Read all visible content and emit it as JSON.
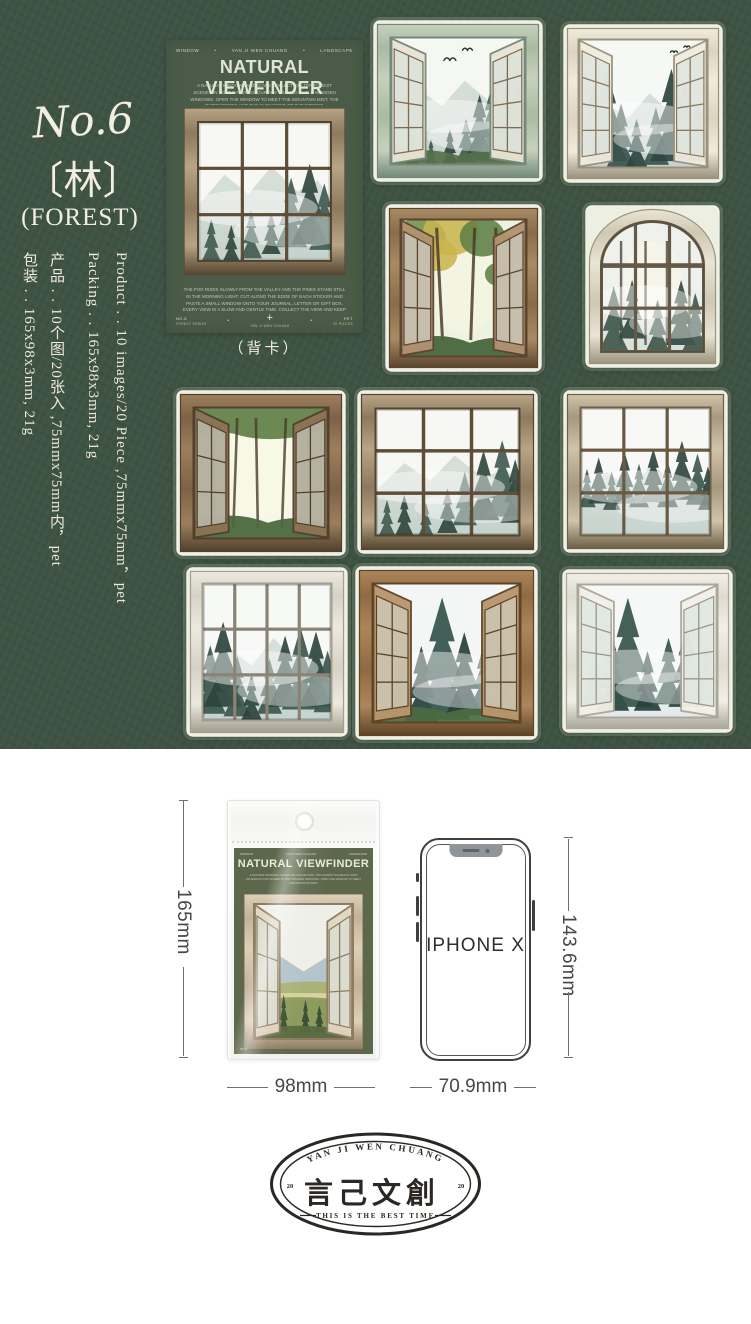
{
  "colors": {
    "background_green": "#3e5343",
    "back_card_green": "#4a5b48",
    "package_card_green": "#5d674b",
    "text_cream": "#f2efe0",
    "stamp_ink": "#2b2723",
    "dimension_line": "#6f6f6f",
    "white": "#ffffff"
  },
  "left_panel": {
    "number": "No.6",
    "kanji": "〔林〕",
    "name": "(FOREST)",
    "columns": [
      {
        "id": "packing-cn",
        "text": "包装 . . 165x98x3mm, 21g"
      },
      {
        "id": "product-cn",
        "text": "产品 . . 10个图/20张入 ,75mmx75mm内，pet"
      },
      {
        "id": "packing-en",
        "text": "Packing . . 165x98x3mm, 21g"
      },
      {
        "id": "product-en",
        "text": "Product . . 10 images/20 Piece ,75mmx75mm，pet"
      }
    ]
  },
  "back_card": {
    "header": {
      "left": "WINDOW",
      "center": "YAN JI WEN CHUANG",
      "right": "LANDSCAPE",
      "dot": "•"
    },
    "title": "NATURAL VIEWFINDER",
    "intro": "A NATURAL WINDOW LANDSCAPE COLLECTION. TEN FOREST SCENES IN SOFT WATERCOLOUR ARE FRAMED IN OLD WOODEN WINDOWS. OPEN THE WINDOW TO MEET THE MOUNTAIN MIST, THE QUIET WOODS AND THE SLOW WIND OF THE FOREST.",
    "desc": "THE FOG RISES SLOWLY FROM THE VALLEY AND THE PINES STAND STILL IN THE MORNING LIGHT. CUT ALONG THE EDGE OF EACH STICKER AND PASTE A SMALL WINDOW ONTO YOUR JOURNAL, LETTER OR GIFT BOX. EVERY VIEW IS A SLOW AND GENTLE TIME. COLLECT THE VIEW AND KEEP THE TIME. TEN IMAGES, TWENTY PIECES, PET MATERIAL.",
    "footer": {
      "left_top": "NO.6",
      "left_sub": "FOREST SERIES",
      "plus": "+",
      "center_sub": "YAN JI WEN CHUANG",
      "right_top": "PET",
      "right_sub": "20 PIECES",
      "dot": "•"
    },
    "caption": "（背卡）",
    "window": {
      "id": "cw",
      "kind": "grid",
      "cut": false,
      "fw": 14,
      "frame": {
        "light": "#b7a485",
        "mid": "#8d7a5e",
        "dark": "#55452f",
        "muntin": "#5e4e38"
      },
      "grid": {
        "cols": 3,
        "rows": 3
      },
      "scene": {
        "sky": "#f7f8f4",
        "fog": "#dee6e1",
        "tree": "#415c52",
        "tree2": "#31483f",
        "ridge": 0.5
      },
      "trees": [
        [
          0.1,
          1,
          0.3
        ],
        [
          0.25,
          1,
          0.26
        ],
        [
          0.4,
          0.98,
          0.34
        ],
        [
          0.55,
          0.95,
          0.3
        ],
        [
          0.7,
          0.9,
          0.5
        ],
        [
          0.84,
          0.88,
          0.58
        ],
        [
          0.95,
          0.92,
          0.48
        ]
      ]
    }
  },
  "stickers": [
    {
      "id": "w1",
      "name": "open casement window, misty mountains with birds",
      "kind": "open",
      "cut": true,
      "fw": 13,
      "sashRows": 4,
      "frame": {
        "light": "#c6d1bd",
        "mid": "#a9bba3",
        "dark": "#74897a",
        "muntin": "#7d6c54",
        "sash": "#e9e5d5"
      },
      "scene": {
        "sky": "#f5f7f3",
        "fog": "#dde6e0",
        "tree": "#3f5a50",
        "tree2": "#2f473f",
        "ridge": 0.52,
        "ground": true,
        "groundColor": "#55704a"
      },
      "trees": [
        [
          0.05,
          1,
          0.2
        ],
        [
          0.16,
          1,
          0.24
        ],
        [
          0.3,
          1,
          0.2
        ],
        [
          0.44,
          1,
          0.28
        ],
        [
          0.56,
          0.98,
          0.34
        ],
        [
          0.66,
          0.95,
          0.5
        ],
        [
          0.76,
          0.97,
          0.62
        ],
        [
          0.86,
          0.92,
          0.52
        ],
        [
          0.95,
          0.96,
          0.58
        ]
      ],
      "birds": true
    },
    {
      "id": "w2",
      "name": "open casement window, foggy pine forest",
      "kind": "open",
      "cut": true,
      "fw": 11,
      "sashRows": 4,
      "frame": {
        "light": "#f0ebdc",
        "mid": "#ddd4c0",
        "dark": "#9a917c",
        "muntin": "#8a7a5f",
        "sash": "#efece0"
      },
      "scene": {
        "sky": "#f6f8f6",
        "fog": "#dfe7e6",
        "tree": "#3a554e",
        "tree2": "#2c453f",
        "ridge": 0.6
      },
      "trees": [
        [
          0.12,
          0.9,
          0.55
        ],
        [
          0.22,
          0.95,
          0.7
        ],
        [
          0.33,
          1,
          0.5
        ],
        [
          0.45,
          1,
          0.38
        ],
        [
          0.6,
          0.98,
          0.45
        ],
        [
          0.72,
          0.95,
          0.72
        ],
        [
          0.83,
          0.9,
          0.58
        ],
        [
          0.93,
          0.95,
          0.48
        ]
      ],
      "birds": "small"
    },
    {
      "id": "w3",
      "name": "open wooden window, lush green forest with golden leaves",
      "kind": "open",
      "cut": true,
      "fw": 11,
      "sashRows": 3,
      "frame": {
        "light": "#a98a63",
        "mid": "#8a6c4a",
        "dark": "#5c452f",
        "muntin": "#5c452f",
        "sash": "#b29272"
      },
      "scene": {
        "sky": "#eef2e0",
        "lush": true,
        "tree": "#5f7f45"
      },
      "trees": []
    },
    {
      "id": "w4",
      "name": "arched stone window, deep forest glow",
      "kind": "arch",
      "cut": true,
      "fw": 12,
      "arch": 0.34,
      "frame": {
        "light": "#e9e4d4",
        "mid": "#cfc8b2",
        "dark": "#9b947e",
        "muntin": "#655948"
      },
      "grid": {
        "cols": 3,
        "rows": 3
      },
      "scene": {
        "sky": "#eef1ec",
        "fog": "#d6dfd9",
        "tree": "#41584c",
        "tree2": "#33493f",
        "bright": [
          0.5,
          0.45
        ],
        "trunks": [
          0.18,
          0.42,
          0.63,
          0.85
        ]
      },
      "trees": [
        [
          0.12,
          1,
          0.5
        ],
        [
          0.3,
          0.9,
          0.45
        ],
        [
          0.55,
          1,
          0.4
        ],
        [
          0.78,
          0.95,
          0.5
        ],
        [
          0.92,
          1,
          0.45
        ]
      ]
    },
    {
      "id": "w5",
      "name": "open brown window, sunlit summer forest",
      "kind": "open",
      "cut": true,
      "fw": 13,
      "sashRows": 3,
      "frame": {
        "light": "#9c7f5d",
        "mid": "#7c6248",
        "dark": "#52402c",
        "muntin": "#52402c",
        "sash": "#8d7356"
      },
      "scene": {
        "sky": "#f6f7e8",
        "sunny": true,
        "tree": "#5d7c43"
      },
      "trees": []
    },
    {
      "id": "w6",
      "name": "rustic nine-pane window, misty pines",
      "kind": "grid",
      "cut": true,
      "fw": 14,
      "frame": {
        "light": "#b7a485",
        "mid": "#8d7a5e",
        "dark": "#55452f",
        "muntin": "#5e4e38"
      },
      "grid": {
        "cols": 3,
        "rows": 3
      },
      "scene": {
        "sky": "#f7f8f4",
        "fog": "#dee6e1",
        "tree": "#415c52",
        "tree2": "#31483f",
        "ridge": 0.55
      },
      "trees": [
        [
          0.08,
          1,
          0.28
        ],
        [
          0.2,
          1,
          0.32
        ],
        [
          0.35,
          1,
          0.26
        ],
        [
          0.5,
          0.98,
          0.35
        ],
        [
          0.62,
          0.92,
          0.42
        ],
        [
          0.75,
          0.88,
          0.55
        ],
        [
          0.88,
          0.85,
          0.6
        ],
        [
          0.97,
          0.9,
          0.5
        ]
      ]
    },
    {
      "id": "w7",
      "name": "whitewashed nine-pane window, fog over pine ridge",
      "kind": "grid",
      "cut": true,
      "fw": 13,
      "frame": {
        "light": "#cfc3a9",
        "mid": "#a79880",
        "dark": "#6e6046",
        "muntin": "#6a5a42"
      },
      "grid": {
        "cols": 3,
        "rows": 3
      },
      "scene": {
        "sky": "#f8f9f6",
        "fog": "#e2e9e6",
        "tree": "#3e584f",
        "tree2": "#2f463e",
        "ridge": 0.62
      },
      "trees": [
        [
          0.05,
          0.78,
          0.3
        ],
        [
          0.14,
          0.75,
          0.36
        ],
        [
          0.24,
          0.8,
          0.3
        ],
        [
          0.34,
          0.75,
          0.4
        ],
        [
          0.45,
          0.78,
          0.34
        ],
        [
          0.56,
          0.74,
          0.42
        ],
        [
          0.67,
          0.78,
          0.36
        ],
        [
          0.78,
          0.72,
          0.46
        ],
        [
          0.9,
          0.76,
          0.4
        ],
        [
          0.98,
          0.8,
          0.34
        ]
      ]
    },
    {
      "id": "w8",
      "name": "white twelve-pane window, misty spruces",
      "kind": "grid",
      "cut": true,
      "fw": 12,
      "frame": {
        "light": "#ece9df",
        "mid": "#d6d2c5",
        "dark": "#a39e8e",
        "muntin": "#8b8474"
      },
      "grid": {
        "cols": 4,
        "rows": 3
      },
      "scene": {
        "sky": "#f7f9f7",
        "fog": "#e0e8e6",
        "tree": "#3c564e",
        "tree2": "#2d443d",
        "ridge": 0.58
      },
      "trees": [
        [
          0.06,
          0.95,
          0.5
        ],
        [
          0.16,
          0.9,
          0.62
        ],
        [
          0.27,
          0.97,
          0.44
        ],
        [
          0.38,
          1,
          0.34
        ],
        [
          0.52,
          0.95,
          0.4
        ],
        [
          0.64,
          0.9,
          0.52
        ],
        [
          0.76,
          0.92,
          0.6
        ],
        [
          0.88,
          0.9,
          0.55
        ],
        [
          0.97,
          0.94,
          0.45
        ]
      ]
    },
    {
      "id": "w9",
      "name": "open brown casement, tall spruce in mist",
      "kind": "open",
      "cut": true,
      "fw": 13,
      "sashRows": 4,
      "frame": {
        "light": "#ad855a",
        "mid": "#8f6a42",
        "dark": "#5e4426",
        "muntin": "#5e4426",
        "sash": "#b9966d"
      },
      "scene": {
        "sky": "#f3f6f4",
        "fog": "#dfe8ea",
        "tree": "#33514a",
        "tree2": "#27403a",
        "ground": true,
        "groundColor": "#4c6b42"
      },
      "trees": [
        [
          0.2,
          0.92,
          0.4
        ],
        [
          0.33,
          1,
          0.55
        ],
        [
          0.47,
          0.98,
          0.88
        ],
        [
          0.62,
          0.95,
          0.6
        ],
        [
          0.75,
          0.9,
          0.45
        ],
        [
          0.88,
          0.92,
          0.5
        ]
      ]
    },
    {
      "id": "w10",
      "name": "open white casement, foggy spruce forest",
      "kind": "open",
      "cut": true,
      "fw": 11,
      "sashRows": 4,
      "frame": {
        "light": "#f1efe7",
        "mid": "#dedbd0",
        "dark": "#aaa79a",
        "muntin": "#9a9688",
        "sash": "#f2f0e8"
      },
      "scene": {
        "sky": "#f5f8f6",
        "fog": "#e2eaea",
        "tree": "#35524a",
        "tree2": "#284039"
      },
      "trees": [
        [
          0.12,
          0.9,
          0.4
        ],
        [
          0.25,
          0.95,
          0.55
        ],
        [
          0.36,
          0.92,
          0.82
        ],
        [
          0.5,
          0.95,
          0.45
        ],
        [
          0.65,
          0.9,
          0.5
        ],
        [
          0.78,
          0.92,
          0.6
        ],
        [
          0.92,
          0.88,
          0.45
        ]
      ]
    }
  ],
  "package": {
    "header": {
      "left": "WINDOW",
      "center": "YAN JI WEN CHUANG",
      "right": "LANDSCAPE"
    },
    "title": "NATURAL VIEWFINDER",
    "para": "A NATURAL WINDOW LANDSCAPE COLLECTION. TEN FOREST SCENES IN SOFT WATERCOLOUR FRAMED IN OLD WOODEN WINDOWS. OPEN THE WINDOW TO MEET THE MOUNTAIN MIST.",
    "footnote": "NO.6",
    "window": {
      "id": "pw",
      "kind": "open",
      "cut": false,
      "fw": 10,
      "sashRows": 3,
      "frame": {
        "light": "#ddd0b8",
        "mid": "#c2b299",
        "dark": "#8d7c62",
        "muntin": "#8d7c62",
        "sash": "#e2d6c0"
      },
      "scene": {
        "sky": "#eef0e8",
        "landscape": true
      },
      "trees": []
    }
  },
  "size_guide": {
    "package_height": "165mm",
    "package_width": "98mm",
    "phone_label": "IPHONE X",
    "phone_height": "143.6mm",
    "phone_width": "70.9mm"
  },
  "stamp": {
    "arc_text": "YAN JI WEN CHUANG",
    "main_text": "言己文創",
    "year_left": "20",
    "year_right": "20",
    "tagline": "THIS IS THE BEST TIME"
  }
}
